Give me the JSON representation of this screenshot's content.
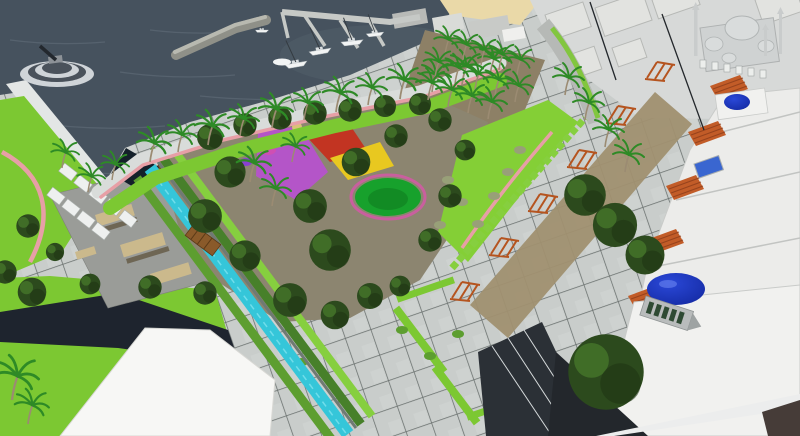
{
  "meta": {
    "kind": "architectural-3d-visualization",
    "description": "Aerial 3D render of a seaside park masterplan with marina, canal, plaza, playground and mosque",
    "width_px": 800,
    "height_px": 436
  },
  "scene": {
    "regions": [
      {
        "id": "sea",
        "label": "harbor sea water"
      },
      {
        "id": "breakwater",
        "label": "stone breakwater jetty"
      },
      {
        "id": "monument",
        "label": "round stepped monument platform in water"
      },
      {
        "id": "marina",
        "label": "marina docks with sailboats"
      },
      {
        "id": "quay-buildings",
        "label": "harbor quay buildings"
      },
      {
        "id": "beach",
        "label": "sand beach strip"
      },
      {
        "id": "waterfront-promenade",
        "label": "palm-lined waterfront promenade"
      },
      {
        "id": "left-road",
        "label": "coastal road"
      },
      {
        "id": "left-lawn",
        "label": "lawn with pink path"
      },
      {
        "id": "stall-rows",
        "label": "rows of white shade canopies"
      },
      {
        "id": "wood-pergolas",
        "label": "timber pergola terrace"
      },
      {
        "id": "skatepark",
        "label": "gray plaza with tan ramps"
      },
      {
        "id": "canal",
        "label": "turquoise canal with hedges"
      },
      {
        "id": "canal-bridge",
        "label": "wooden canal bridge"
      },
      {
        "id": "park",
        "label": "central park with trees"
      },
      {
        "id": "playground",
        "label": "colorful playground surfacing"
      },
      {
        "id": "lawn-circle",
        "label": "circular event lawn with pink ring"
      },
      {
        "id": "east-lawn",
        "label": "east lawns with shrubs"
      },
      {
        "id": "plaza",
        "label": "gridded paved plaza"
      },
      {
        "id": "pergola-walk",
        "label": "row of rust steel pergolas"
      },
      {
        "id": "shops",
        "label": "white shops with orange tiled awnings"
      },
      {
        "id": "dome-building",
        "label": "white building with large blue dome"
      },
      {
        "id": "small-dome",
        "label": "small blue dome building"
      },
      {
        "id": "mosque",
        "label": "mosque with domes and minarets"
      },
      {
        "id": "city-blocks",
        "label": "white city massing blocks"
      },
      {
        "id": "glass-canopy",
        "label": "dark glass canopy roofs"
      },
      {
        "id": "white-roof",
        "label": "large white roof, bottom left"
      },
      {
        "id": "shadow-band",
        "label": "dark shadow path across lawn"
      },
      {
        "id": "light-poles",
        "label": "tall street light poles"
      },
      {
        "id": "big-tree",
        "label": "large tree by dome building"
      }
    ]
  },
  "palette": {
    "sea": "#46525e",
    "sea-light": "#5d6a76",
    "harbor-glow": "#525e6a",
    "breakwater": "#8f9088",
    "breakwater-top": "#b8b9b0",
    "dock": "#c6c9c6",
    "quay-a": "#b8bab7",
    "quay-b": "#d9dbd8",
    "quay-c": "#c8cac7",
    "sand": "#ead9a8",
    "boat-hull": "#f2f4f4",
    "boat-deck": "#d9dee0",
    "mast": "#343b41",
    "road": "#e3e6e5",
    "street-gray": "#b6b9b6",
    "promenade": "#d9dcda",
    "path-pink": "#e79fa6",
    "lawn": "#7cc832",
    "lawn-bright": "#84cf36",
    "hedge-dark": "#47802a",
    "hedge-mid": "#5d9e30",
    "hedge-light": "#86cf3f",
    "tree-dark": "#2c4a1d",
    "tree-mid": "#477a2b",
    "tree-shadow": "#1f3614",
    "palm-green": "#2e8a26",
    "trunk": "#9b8b72",
    "park-ground": "#8c8570",
    "grove-ground": "#8d8066",
    "street-ground": "#a09070",
    "canal": "#35c6d9",
    "canal-dark": "#14202a",
    "paving": "#c9cdcb",
    "paving-2": "#d2d6d4",
    "paving-joint": "#4f5654",
    "plaza-gray": "#9a9c98",
    "ramp-tan": "#cbb98c",
    "ramp-face": "#6e6654",
    "stall-white": "#eef0ef",
    "wood-pergola": "#7b5026",
    "wood-slat": "#5c3a17",
    "rust-pergola": "#b5541f",
    "play-purple": "#b455c8",
    "play-red": "#c23422",
    "play-yellow": "#e8c820",
    "play-green": "#17a12c",
    "ring-pink": "#c95f9e",
    "building-white": "#ececea",
    "building-white-2": "#f1f1ef",
    "building-edge": "#c2c4c2",
    "city-block": "#e2e3e0",
    "city-side": "#b6b8b5",
    "awning": "#c25c28",
    "awning-slat": "#8f3e1b",
    "dome-blue": "#2a48d8",
    "dome-deep": "#12279d",
    "skylight-blue": "#3a66d0",
    "mosque-gray": "#d7d9d8",
    "mosque-dome": "#d9dcdc",
    "louver-green": "#2e4a33",
    "glass-dark": "#2b3036",
    "frame-light": "#d6dadb",
    "shadow-dark": "#1e242e",
    "dark-ground": "#23272c",
    "dark-corner": "#463c38",
    "monument-step": "#cfd4d8",
    "monument-dark": "#4a525b",
    "sculpture": "#23282e",
    "bush-gray": "#98a078"
  }
}
